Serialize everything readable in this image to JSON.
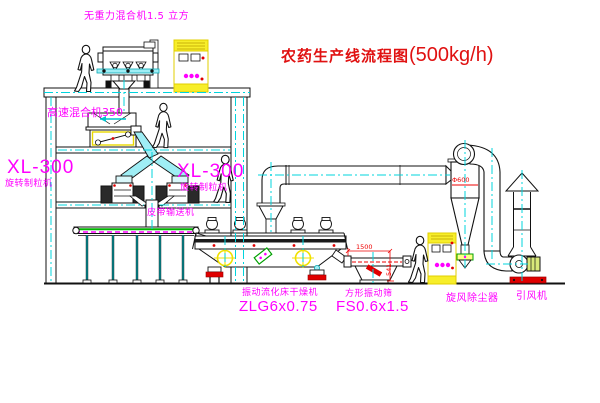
{
  "title": {
    "name": "农药生产线流程图",
    "capacity": "(500kg/h)"
  },
  "machines": {
    "gravity_mixer": {
      "label": "无重力混合机1.5 立方"
    },
    "high_speed_mixer": {
      "label": "高速混合机350"
    },
    "granulator_left": {
      "model": "XL-300",
      "name": "旋转制粒机"
    },
    "granulator_right": {
      "model": "XL-300",
      "name": "旋转制粒机"
    },
    "belt_conveyor": {
      "name": "皮带输送机"
    },
    "fluid_bed_dryer": {
      "name": "振动流化床干燥机",
      "model": "ZLG6x0.75"
    },
    "vibrating_screen": {
      "name": "方形振动筛",
      "model": "FS0.6x1.5"
    },
    "cyclone": {
      "name": "旋风除尘器",
      "diameter": "Φ600"
    },
    "fan": {
      "name": "引风机"
    }
  },
  "dimensions": {
    "screen_length": "1500",
    "screen_height": "541"
  },
  "colors": {
    "label_magenta": "#ff00ff",
    "title_red": "#e01111",
    "dimension_red": "#ee0000",
    "centerline_cyan": "#00d4dd",
    "cabinet_yellow": "#f0e000",
    "duct_fill_cyan": "#9feef5",
    "conveyor_green": "#00b400",
    "line_black": "#111111",
    "background": "#ffffff"
  }
}
